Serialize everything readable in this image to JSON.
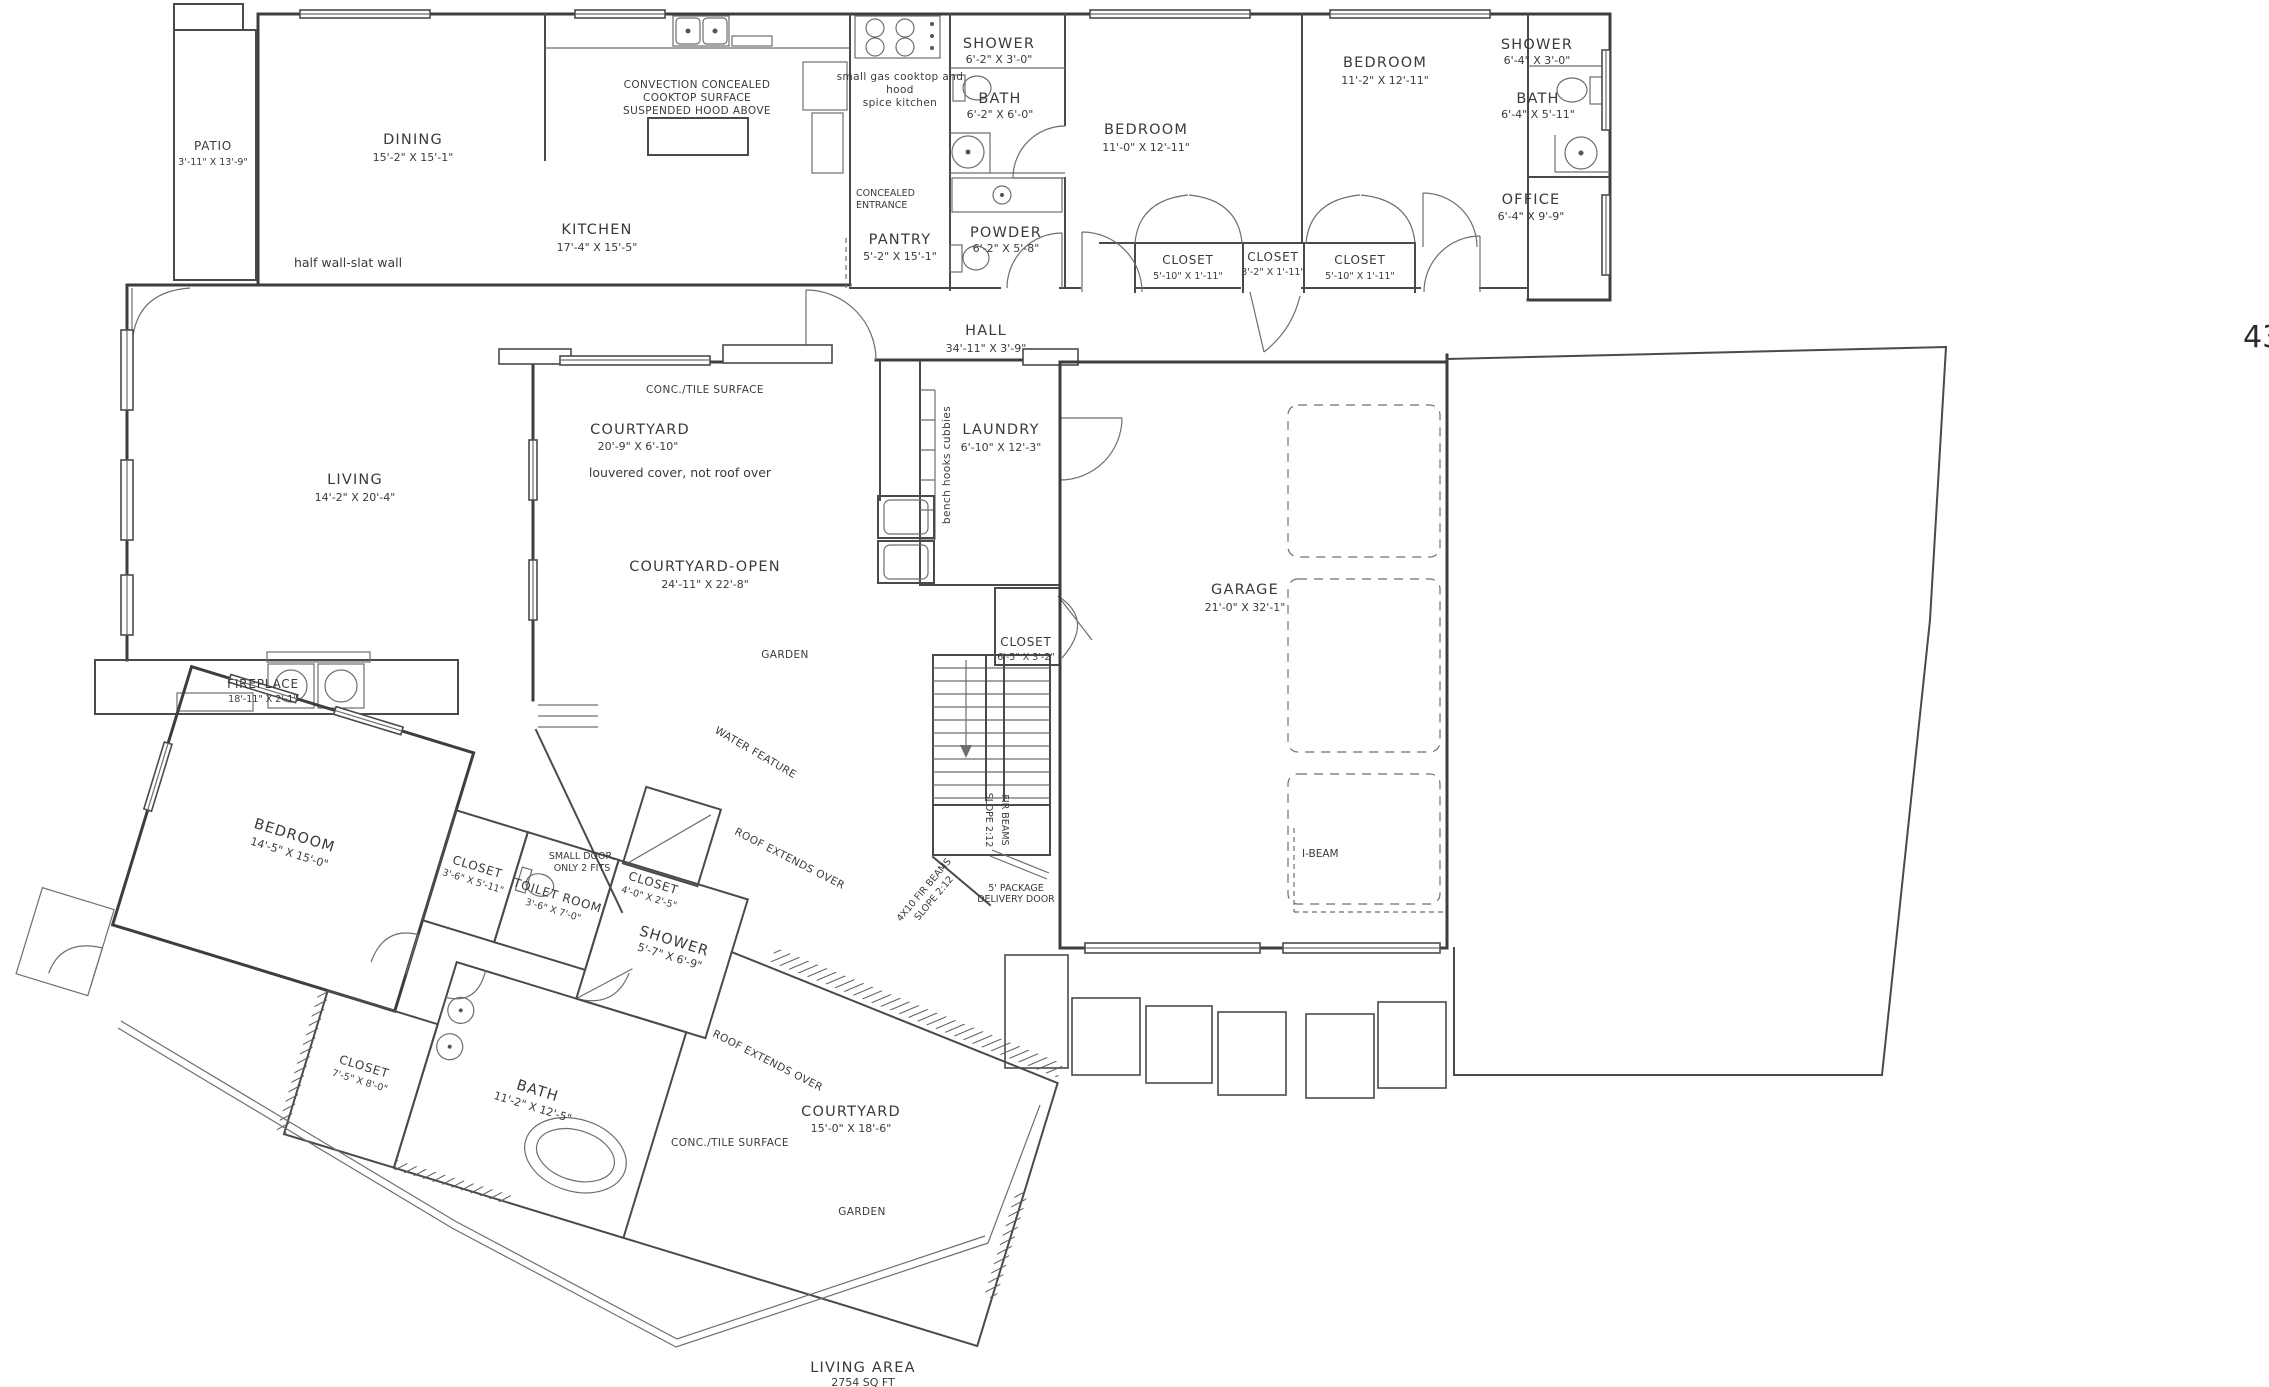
{
  "page_number": "43",
  "colors": {
    "line": "#4a4a4a",
    "text": "#3a3a3a",
    "background": "#ffffff"
  },
  "summary": {
    "label": "LIVING AREA",
    "value": "2754 SQ FT"
  },
  "rooms": {
    "patio": {
      "name": "PATIO",
      "dims": "3'-11\" X 13'-9\""
    },
    "dining": {
      "name": "DINING",
      "dims": "15'-2\" X 15'-1\""
    },
    "kitchen": {
      "name": "KITCHEN",
      "dims": "17'-4\" X 15'-5\""
    },
    "pantry": {
      "name": "PANTRY",
      "dims": "5'-2\" X 15'-1\""
    },
    "shower1": {
      "name": "SHOWER",
      "dims": "6'-2\" X 3'-0\""
    },
    "bath1": {
      "name": "BATH",
      "dims": "6'-2\" X 6'-0\""
    },
    "powder": {
      "name": "POWDER",
      "dims": "6'-2\" X 5'-8\""
    },
    "bedroom1": {
      "name": "BEDROOM",
      "dims": "11'-0\" X 12'-11\""
    },
    "closet_a": {
      "name": "CLOSET",
      "dims": "5'-10\" X 1'-11\""
    },
    "closet_b": {
      "name": "CLOSET",
      "dims": "3'-2\" X 1'-11\""
    },
    "closet_c": {
      "name": "CLOSET",
      "dims": "5'-10\" X 1'-11\""
    },
    "bedroom2": {
      "name": "BEDROOM",
      "dims": "11'-2\" X 12'-11\""
    },
    "shower2": {
      "name": "SHOWER",
      "dims": "6'-4\" X 3'-0\""
    },
    "bath2": {
      "name": "BATH",
      "dims": "6'-4\" X 5'-11\""
    },
    "office": {
      "name": "OFFICE",
      "dims": "6'-4\" X 9'-9\""
    },
    "hall": {
      "name": "HALL",
      "dims": "34'-11\" X 3'-9\""
    },
    "living": {
      "name": "LIVING",
      "dims": "14'-2\" X 20'-4\""
    },
    "fireplace": {
      "name": "FIREPLACE",
      "dims": "18'-11\" X 2'-1\""
    },
    "courtyard_upper": {
      "name": "COURTYARD",
      "dims": "20'-9\" X 6'-10\""
    },
    "courtyard_open": {
      "name": "COURTYARD-OPEN",
      "dims": "24'-11\" X 22'-8\""
    },
    "laundry": {
      "name": "LAUNDRY",
      "dims": "6'-10\" X 12'-3\""
    },
    "closet_stairs": {
      "name": "CLOSET",
      "dims": "6'-5\" X 3'-2\""
    },
    "garage": {
      "name": "GARAGE",
      "dims": "21'-0\" X 32'-1\""
    },
    "bedroom3": {
      "name": "BEDROOM",
      "dims": "14'-5\" X 15'-0\""
    },
    "closet_d": {
      "name": "CLOSET",
      "dims": "3'-6\" X 5'-11\""
    },
    "closet_small": {
      "name": "CLOSET",
      "dims": "4'-0\" X 2'-5\""
    },
    "toilet_room": {
      "name": "TOILET ROOM",
      "dims": "3'-6\" X 7'-0\""
    },
    "shower3": {
      "name": "SHOWER",
      "dims": "5'-7\" X 6'-9\""
    },
    "closet_e": {
      "name": "CLOSET",
      "dims": "7'-5\" X 8'-0\""
    },
    "bath3": {
      "name": "BATH",
      "dims": "11'-2\" X 12'-5\""
    },
    "courtyard_lower": {
      "name": "COURTYARD",
      "dims": "15'-0\" X 18'-6\""
    }
  },
  "notes": {
    "cooktop_1": "CONVECTION CONCEALED",
    "cooktop_2": "COOKTOP SURFACE",
    "cooktop_3": "SUSPENDED HOOD ABOVE",
    "spice_1": "small gas cooktop and",
    "spice_2": "hood",
    "spice_3": "spice kitchen",
    "concealed_1": "CONCEALED",
    "concealed_2": "ENTRANCE",
    "half_wall": "half wall-slat wall",
    "conc_tile_upper": "CONC./TILE SURFACE",
    "louvered": "louvered cover, not roof over",
    "garden_upper": "GARDEN",
    "bench_cubbies": "bench hooks cubbies",
    "water_feature": "WATER FEATURE",
    "roof_extends_upper": "ROOF EXTENDS OVER",
    "fir_beams_1": "FIR BEAMS",
    "fir_beams_2": "SLOPE 2:12",
    "fir_diag_1": "4X10 FIR BEAMS",
    "fir_diag_2": "SLOPE 2:12",
    "package_1": "5' PACKAGE",
    "package_2": "DELIVERY DOOR",
    "i_beam": "I-BEAM",
    "small_door_1": "SMALL DOOR,",
    "small_door_2": "ONLY 2 FITS",
    "roof_extends_lower": "ROOF EXTENDS OVER",
    "conc_tile_lower": "CONC./TILE SURFACE",
    "garden_lower": "GARDEN"
  }
}
